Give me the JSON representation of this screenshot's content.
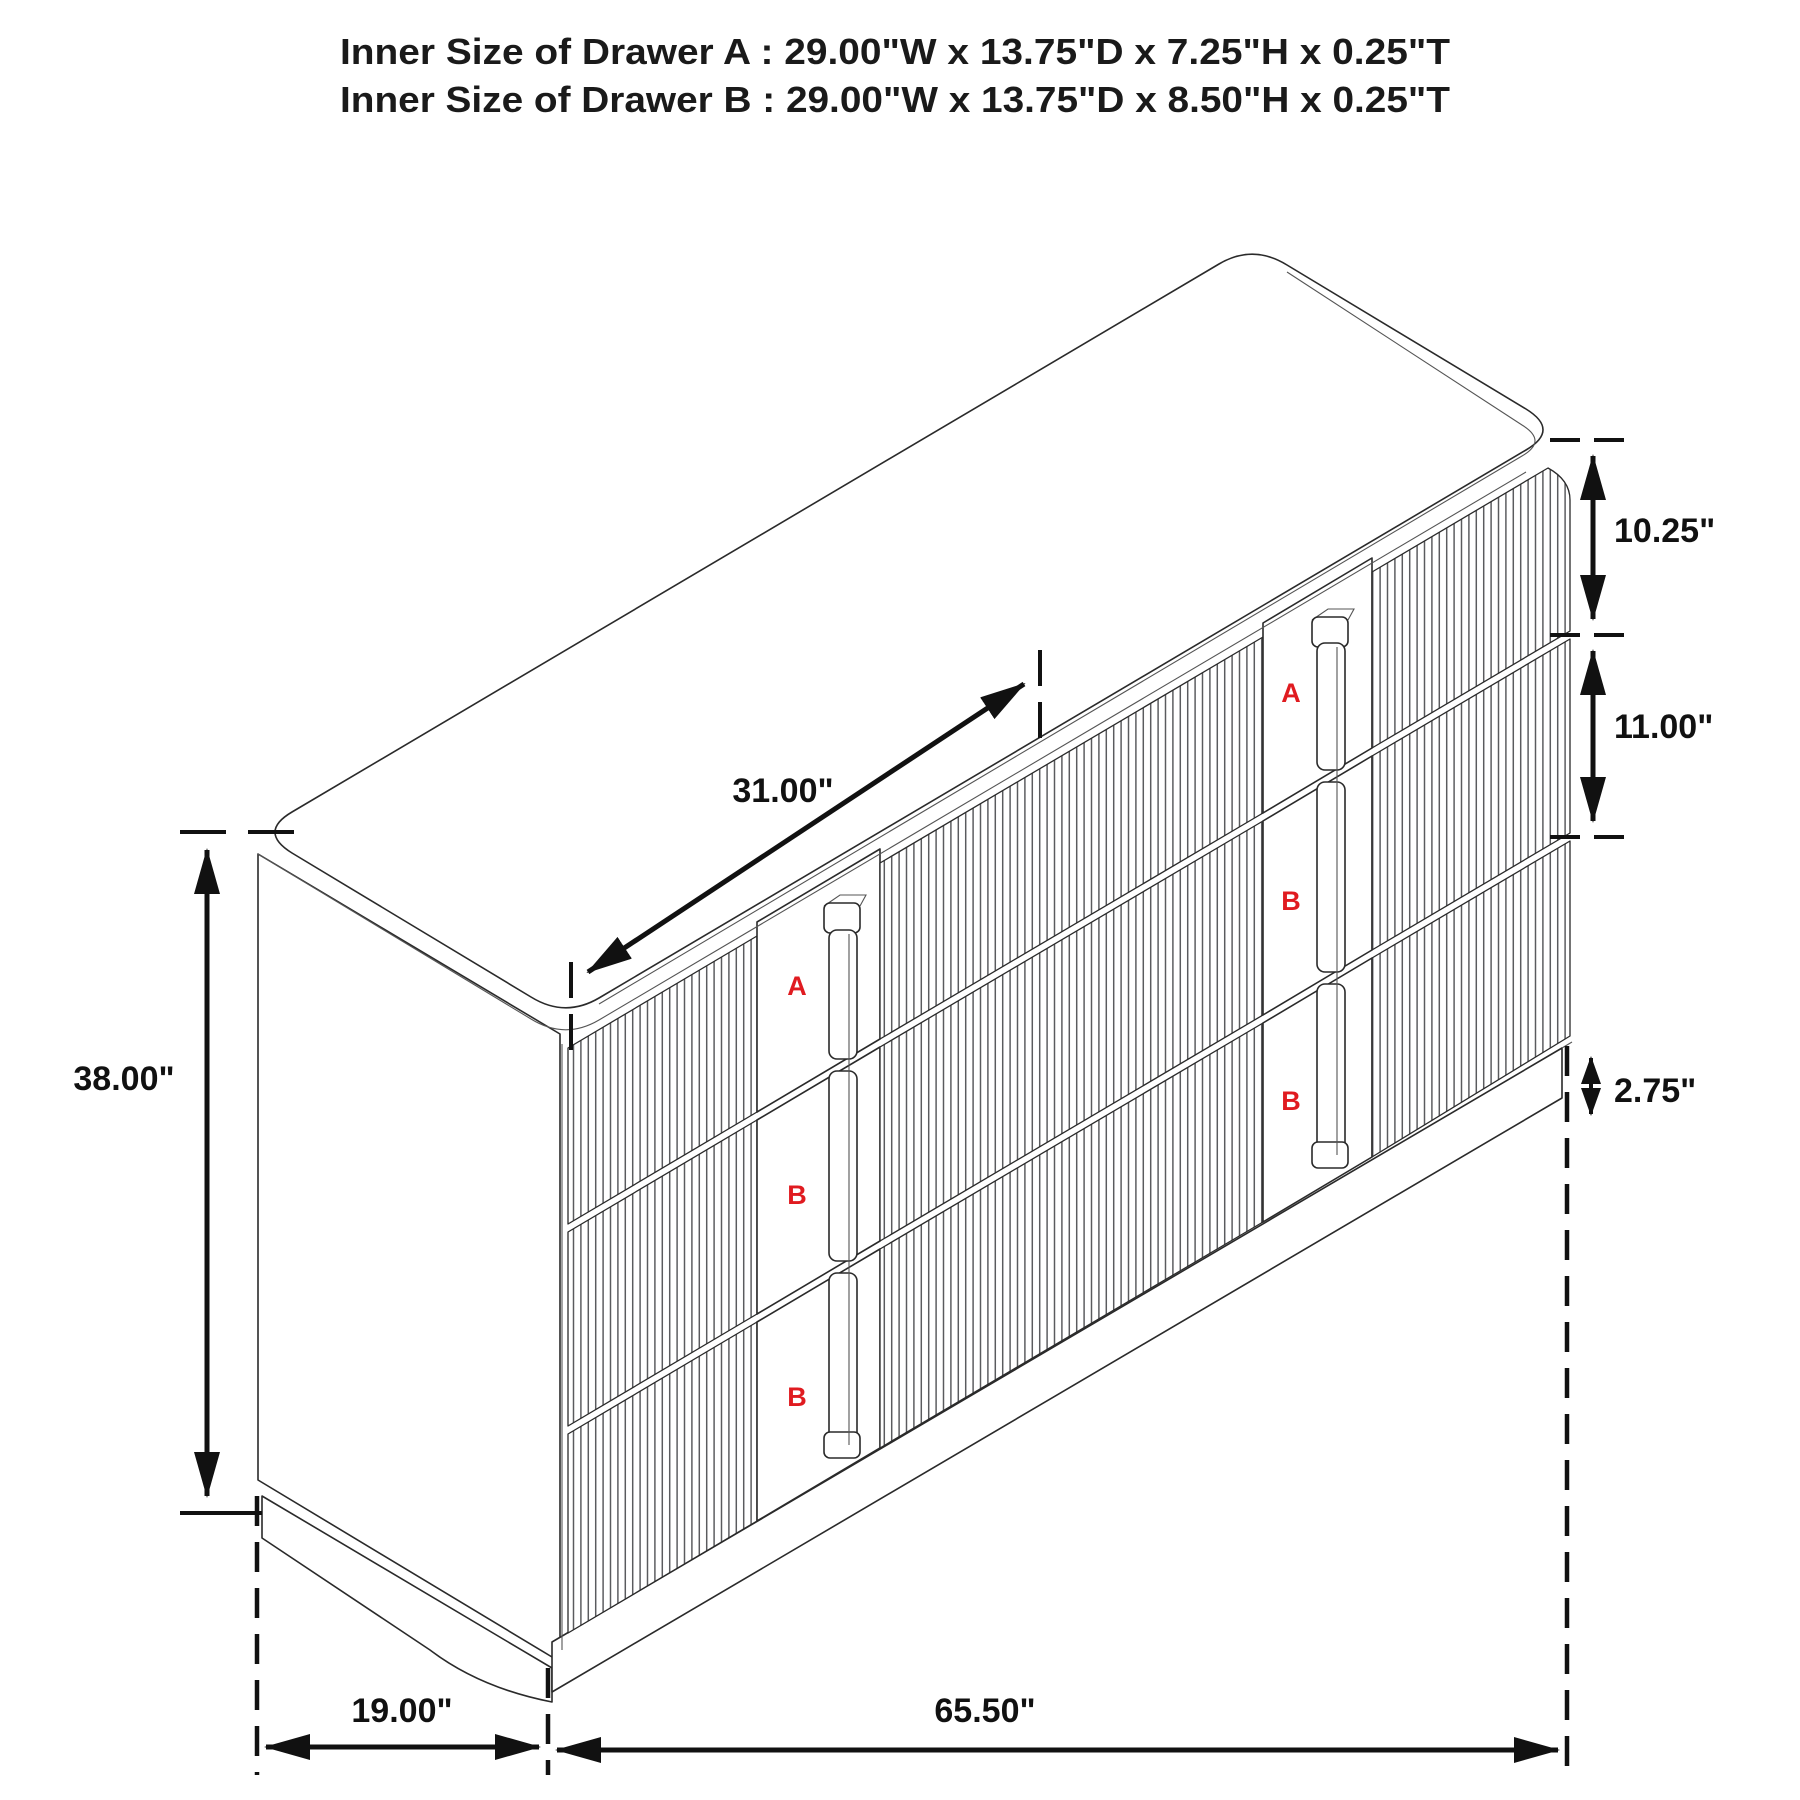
{
  "title": {
    "line_a": "Inner Size of Drawer A : 29.00\"W x 13.75\"D x 7.25\"H x 0.25\"T",
    "line_b": "Inner Size of Drawer B : 29.00\"W x 13.75\"D x 8.50\"H x 0.25\"T"
  },
  "dimensions": {
    "drawer_a_face_height": "10.25\"",
    "drawer_b_face_height": "11.00\"",
    "base_height": "2.75\"",
    "top_drawer_width": "31.00\"",
    "overall_height": "38.00\"",
    "overall_depth": "19.00\"",
    "overall_width": "65.50\""
  },
  "drawer_labels": {
    "left_column": [
      "A",
      "B",
      "B"
    ],
    "right_column": [
      "A",
      "B",
      "B"
    ]
  },
  "colors": {
    "label_red": "#e01b20",
    "line_dark": "#111111"
  }
}
